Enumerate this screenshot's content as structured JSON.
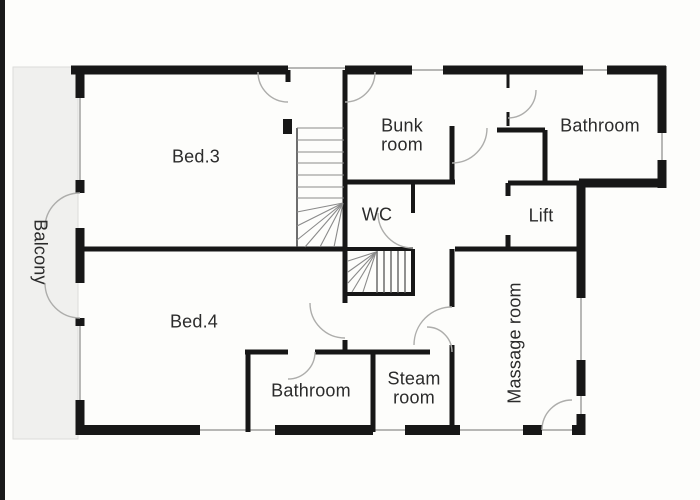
{
  "plan": {
    "title": "First floor plan",
    "rooms": [
      {
        "id": "bed3",
        "label": "Bed.3"
      },
      {
        "id": "bed4",
        "label": "Bed.4"
      },
      {
        "id": "bunk-room",
        "label": "Bunk\nroom"
      },
      {
        "id": "wc",
        "label": "WC"
      },
      {
        "id": "bathroom-top",
        "label": "Bathroom"
      },
      {
        "id": "lift",
        "label": "Lift"
      },
      {
        "id": "massage-room",
        "label": "Massage room"
      },
      {
        "id": "steam-room",
        "label": "Steam\nroom"
      },
      {
        "id": "bathroom-bottom",
        "label": "Bathroom"
      },
      {
        "id": "balcony",
        "label": "Balcony"
      }
    ],
    "features": [
      "upper-staircase",
      "lower-staircase",
      "double-entry-doors",
      "balcony-doors"
    ],
    "colors": {
      "wall": "#171717",
      "window": "#a0a09e",
      "door_arc": "#adadab",
      "balcony_fill": "#f0f0ee",
      "text": "#2b2b2b",
      "background": "#fdfdfb",
      "edge": "#1a1a1a"
    }
  }
}
